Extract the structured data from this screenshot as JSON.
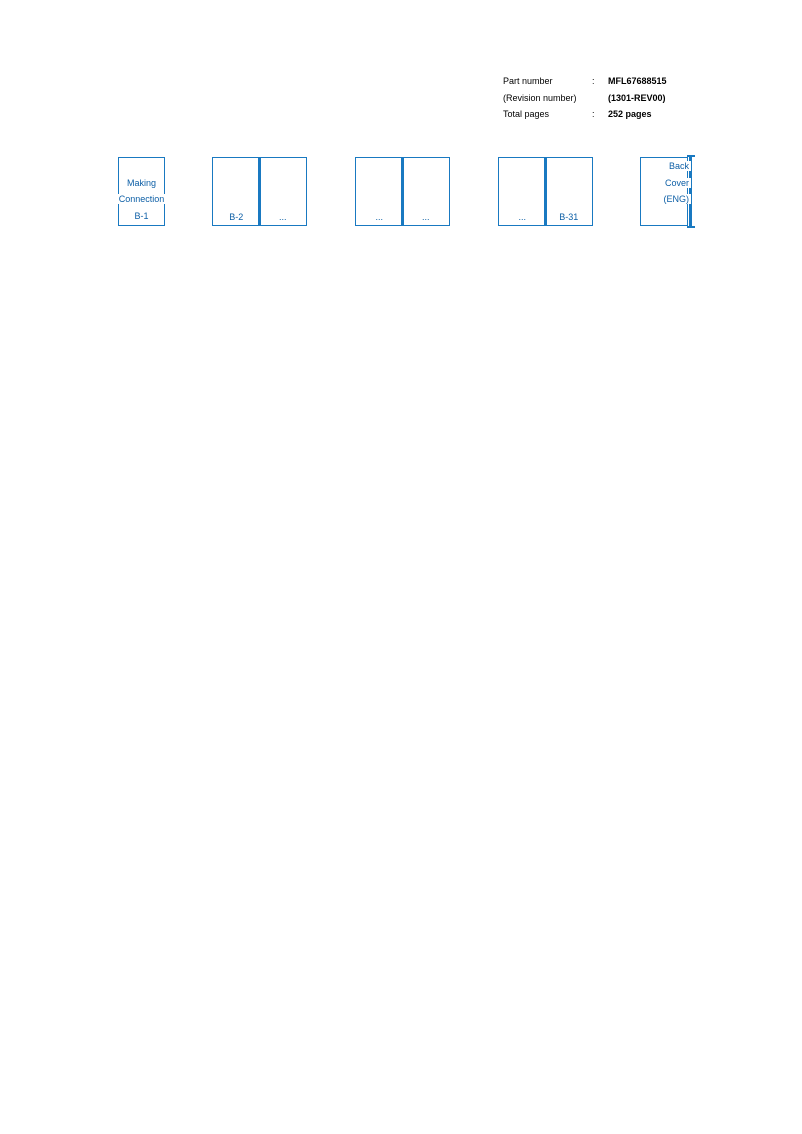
{
  "colors": {
    "accent_border": "#1979c1",
    "accent_text": "#0d5fa6"
  },
  "info": {
    "rows": [
      {
        "label": "Part number",
        "colon": ":",
        "value": "MFL67688515"
      },
      {
        "label": "(Revision number)",
        "colon": "",
        "value": "(1301-REV00)"
      },
      {
        "label": "Total pages",
        "colon": ":",
        "value": "252 pages"
      }
    ]
  },
  "pagination": {
    "first_page": {
      "line1": "Making",
      "line2": "Connection",
      "label": "B-1"
    },
    "spread1": {
      "left": "B-2",
      "right": "..."
    },
    "spread2": {
      "left": "...",
      "right": "..."
    },
    "spread3": {
      "left": "...",
      "right": "B-31"
    },
    "back_cover": {
      "line1": "Back",
      "line2": "Cover",
      "line3": "(ENG)"
    }
  }
}
